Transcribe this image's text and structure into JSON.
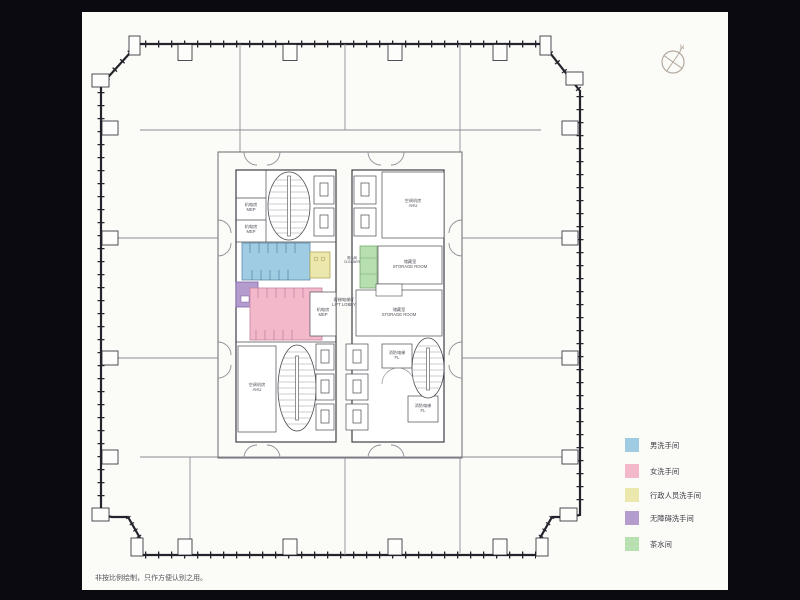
{
  "page": {
    "background": "#0a0a10",
    "paper": "#fbfbf8",
    "note": "非按比例绘制，只作方便认别之用。"
  },
  "compass": {
    "north_label": "N"
  },
  "legend": {
    "items": [
      {
        "id": "mens-restroom",
        "label": "男洗手间",
        "color": "#9fcce2"
      },
      {
        "id": "womens-restroom",
        "label": "女洗手间",
        "color": "#f3b9cb"
      },
      {
        "id": "executive-restroom",
        "label": "行政人员洗手间",
        "color": "#ece8ad"
      },
      {
        "id": "accessible-restroom",
        "label": "无障碍洗手间",
        "color": "#b49ccf"
      },
      {
        "id": "pantry",
        "label": "茶水间",
        "color": "#b8dfb0"
      }
    ]
  },
  "floor_plan": {
    "labels": {
      "mep_upper_a": {
        "zh": "机电房",
        "en": "MEP"
      },
      "mep_upper_b": {
        "zh": "机电房",
        "en": "MEP"
      },
      "ahu_upper": {
        "zh": "空调机房",
        "en": "AHU"
      },
      "cleaner": {
        "zh": "清洁间",
        "en": "CLEANER"
      },
      "storage_upper": {
        "zh": "储藏室",
        "en": "STORAGE ROOM"
      },
      "lift_lobby": {
        "zh": "客梯电梯厅",
        "en": "LIFT LOBBY"
      },
      "mep_mid": {
        "zh": "机电房",
        "en": "MEP"
      },
      "storage_mid": {
        "zh": "储藏室",
        "en": "STORAGE ROOM"
      },
      "ahu_lower": {
        "zh": "空调机房",
        "en": "AHU"
      },
      "fire_lift_a": {
        "zh": "消防电梯",
        "en": "FL"
      },
      "fire_lift_b": {
        "zh": "消防电梯",
        "en": "FL"
      }
    }
  }
}
